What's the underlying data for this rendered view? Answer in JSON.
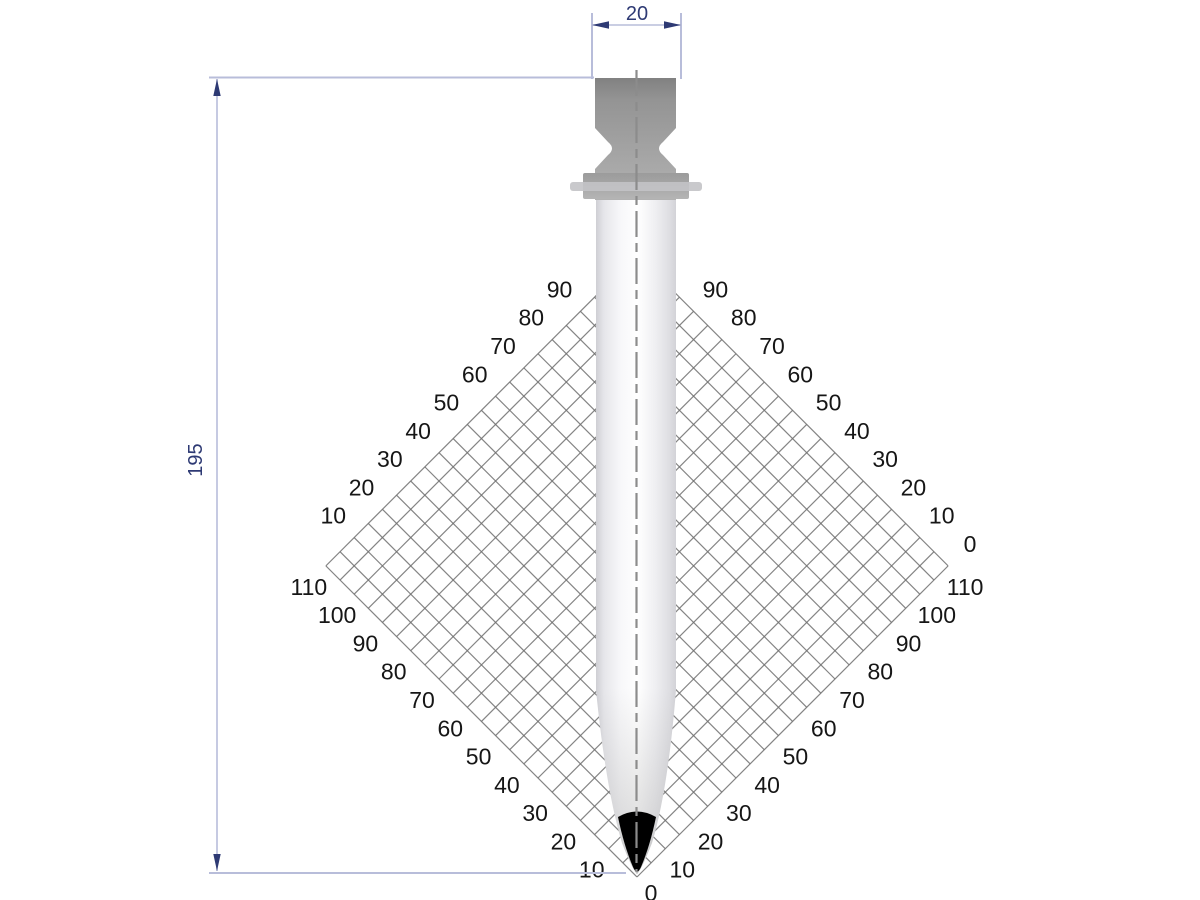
{
  "dimensions": {
    "width": {
      "value": "20"
    },
    "height": {
      "value": "195"
    }
  },
  "grid": {
    "max": 110,
    "step": 5,
    "label_step": 10,
    "scales": {
      "upper_left": [
        "10",
        "20",
        "30",
        "40",
        "50",
        "60",
        "70",
        "80",
        "90"
      ],
      "upper_right": [
        "0",
        "10",
        "20",
        "30",
        "40",
        "50",
        "60",
        "70",
        "80",
        "90"
      ],
      "lower_left": [
        "10",
        "20",
        "30",
        "40",
        "50",
        "60",
        "70",
        "80",
        "90",
        "100",
        "110"
      ],
      "lower_right": [
        "0",
        "10",
        "20",
        "30",
        "40",
        "50",
        "60",
        "70",
        "80",
        "90",
        "100",
        "110"
      ]
    }
  },
  "colors": {
    "dim_line": "#b8bdda",
    "dim_accent": "#2e3a74",
    "grid_line": "#6f6f6f",
    "grid_label": "#161616",
    "tip": "#000000",
    "centerline": "#8c8c8c",
    "background": "#ffffff"
  }
}
